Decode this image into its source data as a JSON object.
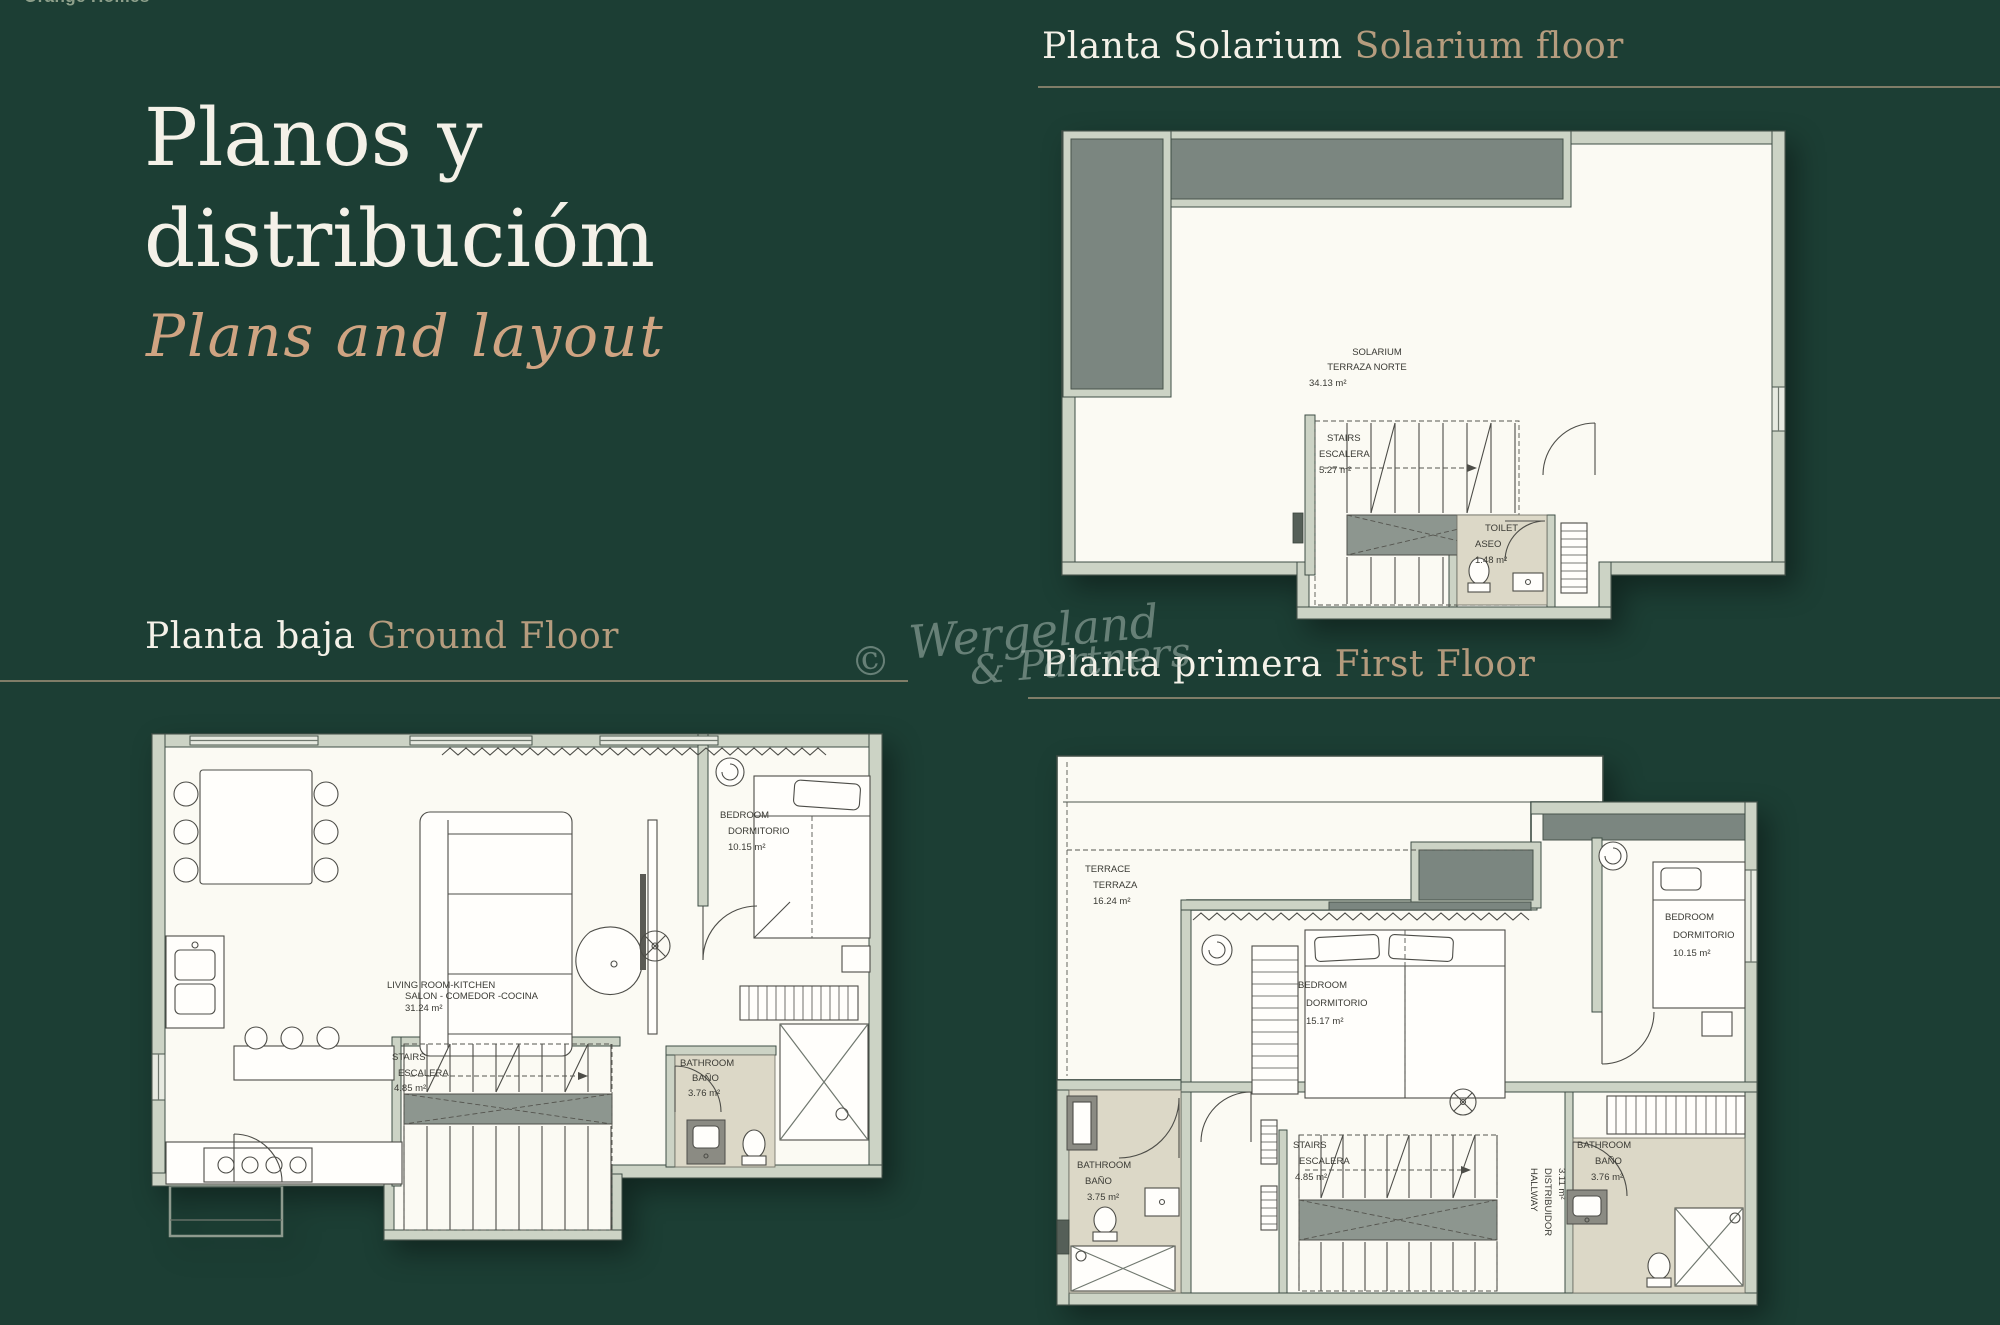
{
  "brand_partial": "Orange Homes",
  "title": {
    "line1": "Planos y",
    "line2": "distribucióm",
    "subtitle": "Plans and layout"
  },
  "watermark": {
    "copyright": "©",
    "line1": "Wergeland",
    "line2": "& Partners"
  },
  "sections": {
    "solarium": {
      "title_es": "Planta Solarium",
      "title_en": "Solarium floor"
    },
    "ground": {
      "title_es": "Planta baja",
      "title_en": "Ground Floor"
    },
    "first": {
      "title_es": "Planta primera",
      "title_en": "First Floor"
    }
  },
  "plans": {
    "solarium": {
      "rooms": [
        {
          "en": "SOLARIUM",
          "es": "TERRAZA NORTE",
          "area": "34.13 m²"
        },
        {
          "en": "STAIRS",
          "es": "ESCALERA",
          "area": "5.27 m²"
        },
        {
          "en": "TOILET",
          "es": "ASEO",
          "area": "1.48 m²"
        }
      ]
    },
    "ground": {
      "rooms": [
        {
          "en": "BEDROOM",
          "es": "DORMITORIO",
          "area": "10.15 m²"
        },
        {
          "en": "LIVING ROOM-KITCHEN",
          "es": "SALON - COMEDOR -COCINA",
          "area": "31.24 m²"
        },
        {
          "en": "STAIRS",
          "es": "ESCALERA",
          "area": "4.85 m²"
        },
        {
          "en": "BATHROOM",
          "es": "BAÑO",
          "area": "3.76 m²"
        }
      ]
    },
    "first": {
      "rooms": [
        {
          "en": "TERRACE",
          "es": "TERRAZA",
          "area": "16.24 m²"
        },
        {
          "en": "BEDROOM",
          "es": "DORMITORIO",
          "area": "15.17 m²"
        },
        {
          "en": "BEDROOM",
          "es": "DORMITORIO",
          "area": "10.15 m²"
        },
        {
          "en": "BATHROOM",
          "es": "BAÑO",
          "area": "3.75 m²"
        },
        {
          "en": "STAIRS",
          "es": "ESCALERA",
          "area": "4.85 m²"
        },
        {
          "en": "HALLWAY",
          "es": "DISTRIBUIDOR",
          "area": "3.11 m²"
        },
        {
          "en": "BATHROOM",
          "es": "BAÑO",
          "area": "3.76 m²"
        }
      ]
    }
  },
  "colors": {
    "background": "#1c3e34",
    "heading_white": "#f4f1e8",
    "heading_tan": "#b59c7e",
    "script_tan": "#cfa482",
    "plan_cream": "#fbfaf3",
    "wall": "#ccd3c5",
    "grey_block": "#7b8680",
    "bath_floor": "#dcd8c7"
  }
}
